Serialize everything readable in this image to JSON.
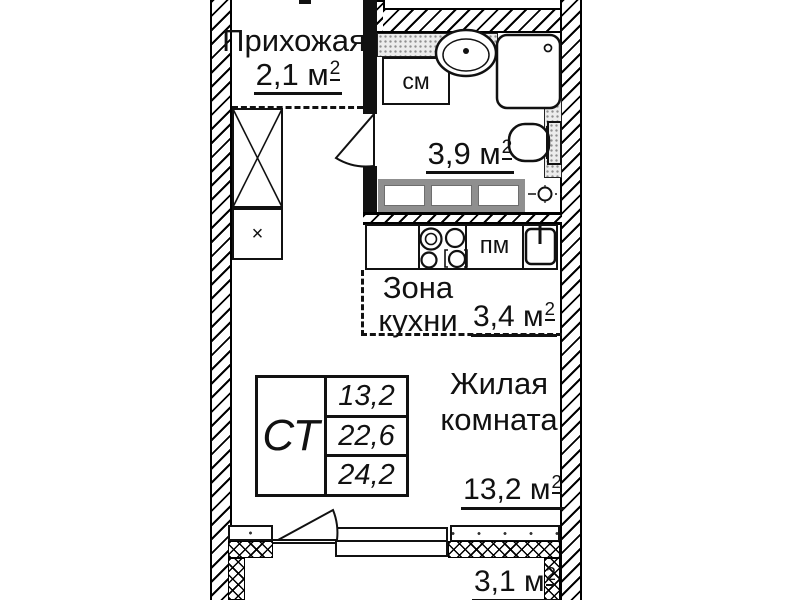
{
  "floorplan": {
    "unit_suffix": "2",
    "rooms": {
      "hallway": {
        "name": "Прихожая",
        "area": "2,1 м"
      },
      "bathroom": {
        "area": "3,9 м"
      },
      "kitchen": {
        "name_line1": "Зона",
        "name_line2": "кухни",
        "area": "3,4 м"
      },
      "living_room": {
        "name_line1": "Жилая",
        "name_line2": "комната",
        "area": "13,2 м"
      },
      "balcony": {
        "area": "3,1 м"
      }
    },
    "appliances": {
      "washing_machine": "см",
      "dishwasher": "пм",
      "closet_mark": "×"
    },
    "info_table": {
      "type_label": "СТ",
      "values": [
        "13,2",
        "22,6",
        "24,2"
      ]
    },
    "colors": {
      "line": "#111111",
      "stipple_fill": "#ececec",
      "rail_gray": "#8f8f8f"
    }
  }
}
